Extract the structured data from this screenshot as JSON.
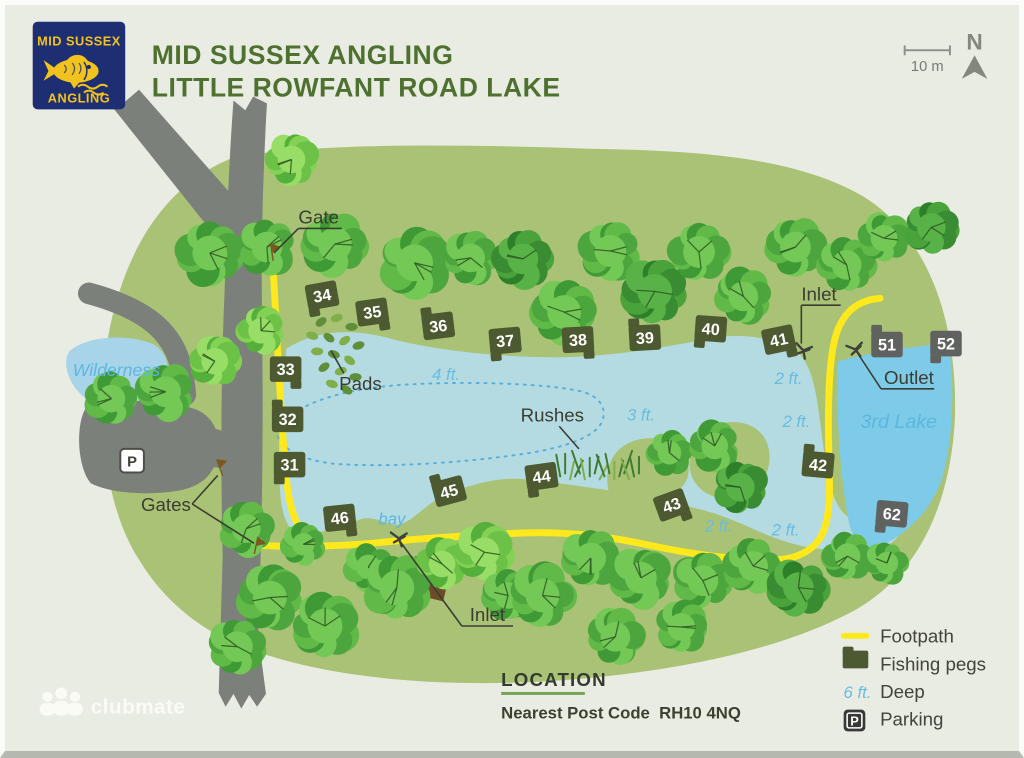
{
  "header": {
    "logo_line1": "MID SUSSEX",
    "logo_line2": "ANGLING",
    "title_line1": "MID SUSSEX ANGLING",
    "title_line2": "LITTLE ROWFANT ROAD LAKE"
  },
  "compass": {
    "north_label": "N",
    "scale_label": "10 m"
  },
  "location": {
    "heading": "LOCATION",
    "line": "Nearest Post Code  RH10 4NQ"
  },
  "footer_logo": {
    "text": "clubmate"
  },
  "legend": {
    "items": [
      {
        "icon": "footpath-line-icon",
        "label": "Footpath"
      },
      {
        "icon": "fishing-peg-icon",
        "label": "Fishing pegs"
      },
      {
        "icon": "depth-text-icon",
        "icon_text": "6 ft.",
        "label": "Deep"
      },
      {
        "icon": "parking-icon",
        "icon_letter": "P",
        "label": "Parking"
      }
    ]
  },
  "map": {
    "parking_icon": {
      "label": "P",
      "x": 126,
      "y": 468
    },
    "colors": {
      "bg": "#e9ece3",
      "grass": "#a9c276",
      "lake": "#b4dbe2",
      "lake3": "#7ecbe9",
      "pond": "#a8d4e9",
      "road": "#7c807b",
      "path": "#ffe81c",
      "contour": "#5aaeda",
      "peg_olive": "#4d5930",
      "peg_gray": "#606260",
      "hut": "#6d4b28",
      "gate": "#7a5a1e",
      "pipe": "#3f4238",
      "leader": "#3b3d32"
    },
    "layers": [
      {
        "name": "grass-area",
        "fill": "grass",
        "d": "M 232,154 C 160,180 118,250 102,335 C 90,415 96,505 132,562 C 162,612 208,646 268,662 C 345,686 455,694 565,686 C 680,677 788,655 862,614 C 928,576 958,502 962,420 C 965,330 940,238 868,194 C 795,152 690,148 590,146 C 470,142 330,139 232,154 Z"
      },
      {
        "name": "wilderness-pond",
        "fill": "pond",
        "d": "M 62,352 C 80,336 120,334 146,344 C 162,352 166,370 158,386 C 146,402 116,410 92,406 C 68,400 52,368 62,352 Z"
      },
      {
        "name": "main-lake",
        "fill": "lake",
        "d": "M 283,349 C 312,331 348,327 392,340 C 442,352 502,358 562,358 C 612,357 662,349 712,339 C 742,333 776,337 798,350 C 813,360 818,379 822,402 C 826,427 828,452 833,477 C 837,498 843,512 853,520 C 869,511 889,508 901,518 C 911,528 908,542 893,549 C 874,557 848,556 820,552 C 797,549 776,541 754,531 C 732,521 710,513 688,509 C 664,504 636,497 610,493 C 582,489 554,485 526,482 C 498,479 468,487 438,501 C 424,508 410,526 396,528 C 384,530 372,516 354,524 C 334,532 308,539 294,536 C 282,532 277,514 276,488 C 274,448 276,394 283,349 Z"
      },
      {
        "name": "third-lake",
        "fill": "lake3",
        "d": "M 843,362 C 882,352 926,346 956,344 C 962,390 960,440 950,478 C 938,516 910,540 885,550 C 869,555 858,545 854,524 C 846,482 841,420 843,362 Z"
      },
      {
        "name": "lake-island",
        "fill": "grass",
        "d": "M 702,438 C 716,423 742,419 759,430 C 774,440 778,461 769,479 C 759,497 736,506 716,499 C 699,493 690,477 693,460 C 695,450 697,443 702,438 Z"
      },
      {
        "name": "lake-peninsula",
        "fill": "grass",
        "d": "M 610,493 C 605,468 616,448 639,442 C 661,436 681,445 689,461 C 695,475 690,489 675,497 C 655,507 628,503 610,493 Z"
      },
      {
        "name": "depth-contour",
        "stroke": "contour",
        "w": 2,
        "dash": "2 6",
        "d": "M 272,432 C 290,405 340,390 400,386 C 460,382 540,384 580,392 C 602,397 608,410 604,422 C 598,440 560,452 510,458 C 450,466 380,470 330,466 C 296,462 275,450 272,432 Z"
      },
      {
        "name": "road-fork-arm",
        "fill": "road",
        "d": "M 99,95 L 112,87 L 118,99 L 133,86 L 245,213 L 217,243 Z"
      },
      {
        "name": "road-main",
        "fill": "road",
        "d": "M 229,97 L 241,107 L 249,93 L 263,100 C 259,170 257,240 258,310 C 259,400 259,490 256,580 L 254,640 L 262,700 L 253,713 L 245,701 L 237,715 L 229,700 L 221,713 L 214,699 L 218,560 C 216,470 216,380 220,290 C 222,220 225,150 229,97 Z"
      },
      {
        "name": "road-branch",
        "stroke": "road",
        "w": 22,
        "d": "M 82,293 C 115,302 145,315 162,338 C 174,354 178,372 180,396"
      },
      {
        "name": "parking-area",
        "fill": "road",
        "d": "M 80,408 C 118,399 164,401 191,411 C 210,419 216,437 213,457 C 209,478 196,490 170,494 C 136,499 101,495 84,486 C 70,470 68,424 80,408 Z"
      },
      {
        "name": "parking-access-road",
        "fill": "road",
        "d": "M 198,427 C 225,434 245,443 258,452 L 258,480 C 238,474 216,470 196,468 Z"
      },
      {
        "name": "footpath-west",
        "stroke": "path",
        "w": 7,
        "d": "M 269,263 C 273,330 276,400 281,462 C 284,504 289,529 307,543"
      },
      {
        "name": "footpath-main",
        "stroke": "path",
        "w": 7,
        "d": "M 254,549 C 292,551 334,550 370,547 C 396,544 430,541 510,537 C 562,534 606,539 652,549 C 694,558 734,563 770,564 C 798,565 819,556 828,536 C 836,517 835,488 834,458 C 833,424 833,372 839,344 C 844,319 858,300 886,298"
      },
      {
        "name": "hut",
        "fill": "hut",
        "d": "M 442,606 L 451,569 L 414,560 L 405,597 Z"
      }
    ],
    "trees": [
      [
        205,
        252,
        34,
        0
      ],
      [
        263,
        246,
        30,
        0
      ],
      [
        288,
        157,
        27,
        2
      ],
      [
        332,
        243,
        33,
        0
      ],
      [
        413,
        262,
        36,
        0
      ],
      [
        470,
        257,
        28,
        0
      ],
      [
        523,
        258,
        30,
        1
      ],
      [
        565,
        312,
        33,
        0
      ],
      [
        612,
        250,
        31,
        0
      ],
      [
        657,
        291,
        34,
        1
      ],
      [
        702,
        251,
        31,
        0
      ],
      [
        747,
        296,
        29,
        0
      ],
      [
        800,
        246,
        30,
        0
      ],
      [
        852,
        264,
        29,
        0
      ],
      [
        890,
        237,
        26,
        0
      ],
      [
        938,
        226,
        28,
        1
      ],
      [
        105,
        400,
        27,
        0
      ],
      [
        160,
        393,
        30,
        0
      ],
      [
        210,
        362,
        26,
        2
      ],
      [
        257,
        331,
        25,
        2
      ],
      [
        242,
        532,
        28,
        0
      ],
      [
        300,
        548,
        22,
        0
      ],
      [
        266,
        602,
        33,
        0
      ],
      [
        233,
        652,
        30,
        0
      ],
      [
        322,
        631,
        34,
        0
      ],
      [
        366,
        571,
        24,
        0
      ],
      [
        395,
        592,
        34,
        0
      ],
      [
        441,
        568,
        26,
        2
      ],
      [
        484,
        556,
        29,
        2
      ],
      [
        508,
        600,
        26,
        0
      ],
      [
        543,
        600,
        33,
        0
      ],
      [
        592,
        562,
        30,
        0
      ],
      [
        643,
        582,
        31,
        0
      ],
      [
        706,
        585,
        30,
        0
      ],
      [
        617,
        642,
        29,
        0
      ],
      [
        684,
        632,
        27,
        0
      ],
      [
        757,
        570,
        29,
        0
      ],
      [
        803,
        592,
        30,
        1
      ],
      [
        853,
        560,
        25,
        0
      ],
      [
        893,
        567,
        22,
        0
      ],
      [
        672,
        455,
        23,
        0
      ],
      [
        718,
        448,
        26,
        0
      ],
      [
        744,
        490,
        28,
        1
      ]
    ],
    "pads": [
      [
        318,
        322
      ],
      [
        334,
        318
      ],
      [
        349,
        327
      ],
      [
        309,
        336
      ],
      [
        326,
        338
      ],
      [
        342,
        341
      ],
      [
        356,
        346
      ],
      [
        314,
        352
      ],
      [
        331,
        355
      ],
      [
        347,
        361
      ],
      [
        321,
        368
      ],
      [
        338,
        372
      ],
      [
        353,
        378
      ],
      [
        329,
        385
      ],
      [
        344,
        391
      ]
    ],
    "rushes": {
      "x": 556,
      "y": 482,
      "count": 18
    },
    "pegs": [
      {
        "n": "34",
        "x": 319,
        "y": 295,
        "rot": -10,
        "c": "peg_olive"
      },
      {
        "n": "35",
        "x": 370,
        "y": 312,
        "rot": -8,
        "c": "peg_olive"
      },
      {
        "n": "36",
        "x": 437,
        "y": 326,
        "rot": -7,
        "c": "peg_olive"
      },
      {
        "n": "37",
        "x": 505,
        "y": 341,
        "rot": -5,
        "c": "peg_olive"
      },
      {
        "n": "38",
        "x": 579,
        "y": 340,
        "rot": -3,
        "c": "peg_olive"
      },
      {
        "n": "39",
        "x": 647,
        "y": 338,
        "rot": -3,
        "c": "peg_olive"
      },
      {
        "n": "40",
        "x": 714,
        "y": 329,
        "rot": 4,
        "c": "peg_olive"
      },
      {
        "n": "41",
        "x": 783,
        "y": 340,
        "rot": -12,
        "c": "peg_olive"
      },
      {
        "n": "51",
        "x": 893,
        "y": 345,
        "rot": 0,
        "c": "peg_gray"
      },
      {
        "n": "52",
        "x": 953,
        "y": 344,
        "rot": 0,
        "c": "peg_gray"
      },
      {
        "n": "33",
        "x": 282,
        "y": 370,
        "rot": 0,
        "c": "peg_olive"
      },
      {
        "n": "32",
        "x": 284,
        "y": 421,
        "rot": 0,
        "c": "peg_olive"
      },
      {
        "n": "31",
        "x": 286,
        "y": 467,
        "rot": 0,
        "c": "peg_olive"
      },
      {
        "n": "46",
        "x": 337,
        "y": 521,
        "rot": -6,
        "c": "peg_olive"
      },
      {
        "n": "45",
        "x": 448,
        "y": 494,
        "rot": -15,
        "c": "peg_olive"
      },
      {
        "n": "44",
        "x": 542,
        "y": 479,
        "rot": -8,
        "c": "peg_olive"
      },
      {
        "n": "43",
        "x": 674,
        "y": 508,
        "rot": -20,
        "c": "peg_olive"
      },
      {
        "n": "42",
        "x": 823,
        "y": 467,
        "rot": 5,
        "c": "peg_olive"
      },
      {
        "n": "62",
        "x": 898,
        "y": 517,
        "rot": 5,
        "c": "peg_gray"
      }
    ],
    "symbols": [
      {
        "type": "pipe",
        "name": "inlet-marker-top",
        "x": 808,
        "y": 351,
        "rot": 10
      },
      {
        "type": "pipe",
        "name": "outlet-marker",
        "x": 861,
        "y": 350,
        "rot": -15
      },
      {
        "type": "pipe",
        "name": "inlet-marker-bay",
        "x": 397,
        "y": 542,
        "rot": 0
      },
      {
        "type": "gate",
        "name": "gate-marker-top",
        "x": 268,
        "y": 251,
        "rot": -8
      },
      {
        "type": "gate",
        "name": "gate-marker-a",
        "x": 215,
        "y": 470,
        "rot": -20
      },
      {
        "type": "gate",
        "name": "gate-marker-b",
        "x": 252,
        "y": 549,
        "rot": 12
      }
    ],
    "feature_labels": [
      {
        "text": "Gate",
        "x": 295,
        "y": 222,
        "anchor": "start",
        "underline": [
          295,
          339,
          227
        ],
        "leaders": [
          [
            [
              295,
              227
            ],
            [
              270,
              252
            ]
          ]
        ]
      },
      {
        "text": "Gates",
        "x": 135,
        "y": 514,
        "anchor": "start",
        "leaders": [
          [
            [
              187,
              507
            ],
            [
              213,
              478
            ]
          ],
          [
            [
              187,
              507
            ],
            [
              250,
              547
            ]
          ]
        ]
      },
      {
        "text": "Pads",
        "x": 358,
        "y": 391,
        "anchor": "middle",
        "leaders": [
          [
            [
              341,
              374
            ],
            [
              328,
              351
            ]
          ]
        ]
      },
      {
        "text": "Rushes",
        "x": 553,
        "y": 423,
        "anchor": "middle",
        "leaders": [
          [
            [
              560,
              428
            ],
            [
              580,
              451
            ]
          ]
        ]
      },
      {
        "text": "Inlet",
        "x": 806,
        "y": 300,
        "anchor": "start",
        "underline": [
          806,
          846,
          305
        ],
        "leaders": [
          [
            [
              806,
              305
            ],
            [
              806,
              344
            ]
          ]
        ]
      },
      {
        "text": "Outlet",
        "x": 890,
        "y": 385,
        "anchor": "start",
        "underline": [
          887,
          941,
          390
        ],
        "leaders": [
          [
            [
              887,
              390
            ],
            [
              864,
              355
            ]
          ]
        ]
      },
      {
        "text": "Inlet",
        "x": 487,
        "y": 626,
        "anchor": "middle",
        "underline": [
          461,
          513,
          631
        ],
        "leaders": [
          [
            [
              461,
              631
            ],
            [
              399,
              546
            ]
          ]
        ]
      }
    ],
    "depth_labels": [
      {
        "text": "4 ft.",
        "x": 445,
        "y": 381
      },
      {
        "text": "3 ft.",
        "x": 643,
        "y": 422
      },
      {
        "text": "2 ft.",
        "x": 793,
        "y": 385
      },
      {
        "text": "2 ft.",
        "x": 801,
        "y": 429
      },
      {
        "text": "2 ft.",
        "x": 722,
        "y": 535
      },
      {
        "text": "2 ft.",
        "x": 790,
        "y": 539
      }
    ],
    "water_labels": [
      {
        "text": "Wilderness",
        "x": 110,
        "y": 377,
        "size": 18,
        "color": "#75c4ea"
      },
      {
        "text": "3rd Lake",
        "x": 905,
        "y": 430,
        "size": 20,
        "color": "#57b4dd"
      },
      {
        "text": "bay",
        "x": 390,
        "y": 528,
        "size": 17,
        "color": "#58b2d8"
      }
    ]
  }
}
